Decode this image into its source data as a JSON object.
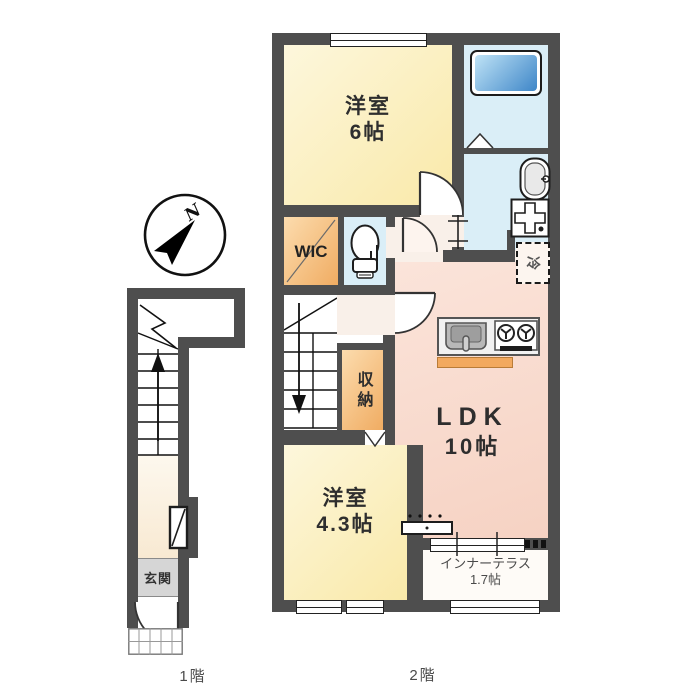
{
  "plan": {
    "floor1_label": "1階",
    "floor2_label": "2階"
  },
  "compass": {
    "north": "N"
  },
  "floor2": {
    "room_west_6": {
      "name": "洋室",
      "size": "6帖"
    },
    "wic": {
      "label": "WIC"
    },
    "closet": {
      "label": "収納"
    },
    "ldk": {
      "name": "LDK",
      "size": "10帖"
    },
    "room_west_43": {
      "name": "洋室",
      "size": "4.3帖"
    },
    "inner_terrace": {
      "name": "インナーテラス",
      "size": "1.7帖"
    },
    "fridge": {
      "label": "冷"
    }
  },
  "floor1": {
    "entrance": {
      "label": "玄関"
    }
  },
  "colors": {
    "wall": "#4e4e4e",
    "room_yellow": "#f9e9a9",
    "ldk_pink": "#f6d2c3",
    "corridor": "#f9f0e9",
    "water_blue": "#daeef7",
    "bathtub_blue": "#3e86c8",
    "wic_orange": "#f0ac62",
    "kitchen_counter_orange": "#f2a95f",
    "entrance_gray": "#d6d6d6",
    "floor1_cream": "#faf1e1"
  }
}
